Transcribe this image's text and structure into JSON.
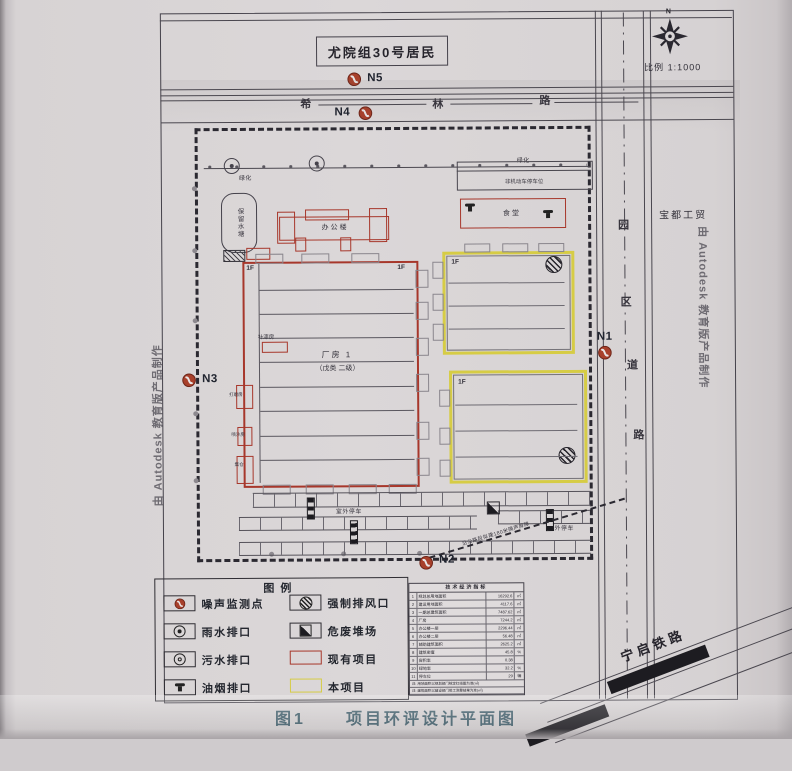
{
  "caption": {
    "prefix": "图1",
    "title": "项目环评设计平面图"
  },
  "compass": {
    "north": "N",
    "scale": "比例 1:1000"
  },
  "watermark": {
    "text": "由 Autodesk 教育版产品制作"
  },
  "neighbors": {
    "residents": "尤院组30号居民",
    "company": "宝都工贸",
    "railway": "宁启铁路"
  },
  "roads": {
    "top": [
      "希",
      "林",
      "路"
    ],
    "right": [
      "园",
      "区",
      "道",
      "路"
    ]
  },
  "monitors": {
    "n1": "N1",
    "n2": "N2",
    "n3": "N3",
    "n4": "N4",
    "n5": "N5"
  },
  "site": {
    "greening_left": "绿化",
    "greening_right": "绿化",
    "pond": "保留水塘",
    "bike_parking": "非机动车停车位",
    "office": "办公楼",
    "canteen": "食堂",
    "factory_name": "厂房 1",
    "factory_class": "（戊类 二级）",
    "floor_tag": "1F",
    "paint_room": "补漆房",
    "side_room_1": "打磨房",
    "side_room_2": "喷沙房",
    "side_room_3": "集仓",
    "outdoor_parking_1": "室外停车",
    "outdoor_parking_2": "室外停车",
    "barrier_note": "沿公路段拟建180米隔声屏障"
  },
  "legend": {
    "title": "图例",
    "items": [
      {
        "label": "噪声监测点",
        "icon": "noise-monitor-icon"
      },
      {
        "label": "雨水排口",
        "icon": "rainwater-outlet-icon"
      },
      {
        "label": "污水排口",
        "icon": "sewage-outlet-icon"
      },
      {
        "label": "油烟排口",
        "icon": "fume-outlet-icon"
      },
      {
        "label": "强制排风口",
        "icon": "forced-exhaust-icon"
      },
      {
        "label": "危废堆场",
        "icon": "hazardous-waste-icon"
      },
      {
        "label": "现有项目",
        "icon": "existing-project-swatch"
      },
      {
        "label": "本项目",
        "icon": "this-project-swatch"
      }
    ]
  },
  "table": {
    "title": "技术经济指标",
    "rows": [
      [
        "1",
        "规划总用地面积",
        "16292.6",
        "㎡"
      ],
      [
        "2",
        "建设用地面积",
        "4117.6",
        "㎡"
      ],
      [
        "3",
        "一期总建筑面积",
        "7487.62",
        "㎡"
      ],
      [
        "4",
        "厂房",
        "7244.2",
        "㎡"
      ],
      [
        "5",
        "办公楼一层",
        "2296.44",
        "㎡"
      ],
      [
        "6",
        "办公楼二层",
        "56.48",
        "㎡"
      ],
      [
        "7",
        "辅助建筑面积",
        "2625.2",
        "㎡"
      ],
      [
        "8",
        "建筑密度",
        "45.8",
        "%"
      ],
      [
        "9",
        "容积率",
        "0.38",
        ""
      ],
      [
        "10",
        "绿地率",
        "32.2",
        "%"
      ],
      [
        "11",
        "停车位",
        "29",
        "辆"
      ]
    ],
    "notes": [
      "注: 用地面积以规划部门核定红线图为准(㎡)",
      "注: 建筑面积以建设部门竣工测量结果为准(㎡)"
    ]
  },
  "colors": {
    "existing_project": "#a7372b",
    "this_project": "#d6cc45",
    "monitor_point": "#a8402b",
    "caption": "#41606d"
  }
}
